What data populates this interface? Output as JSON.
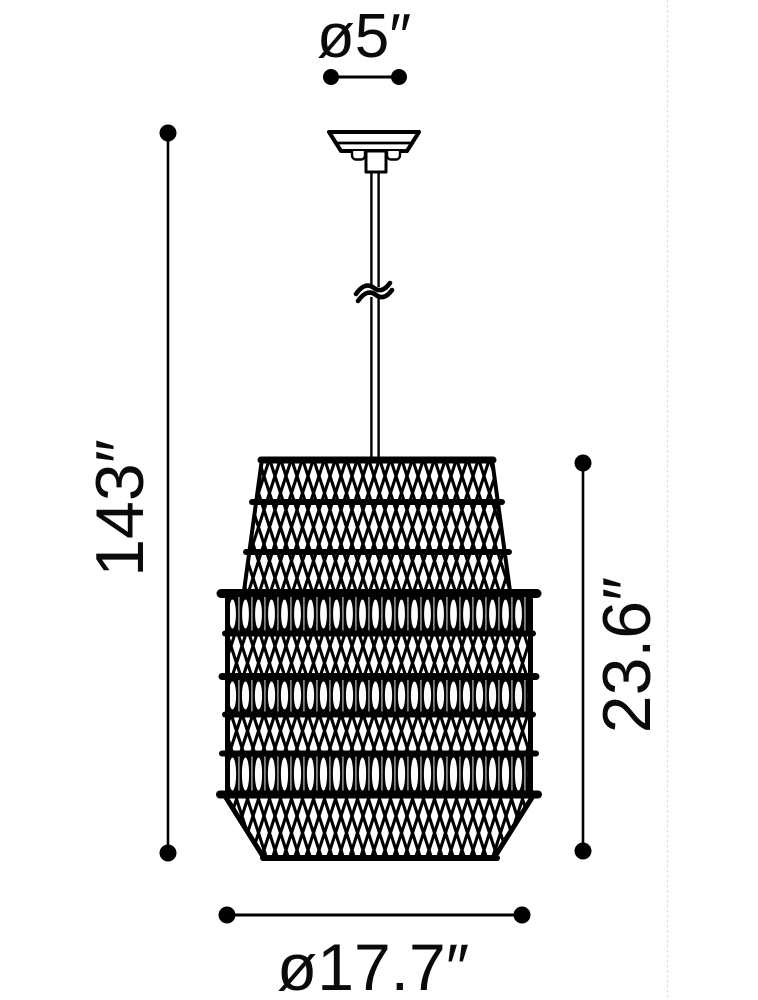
{
  "diagram": {
    "kind": "product-dimension-drawing",
    "subject": "woven-rattan-pendant-lamp",
    "background_color": "#ffffff",
    "line_color": "#000000",
    "divider_color": "#dcdcdc",
    "unit": "inches",
    "labels": {
      "canopy_diameter": "ø5″",
      "overall_height": "143″",
      "shade_height": "23.6″",
      "shade_diameter": "ø17.7″"
    },
    "values": {
      "canopy_diameter_in": 5,
      "overall_height_in": 143,
      "shade_height_in": 23.6,
      "shade_diameter_in": 17.7
    }
  }
}
